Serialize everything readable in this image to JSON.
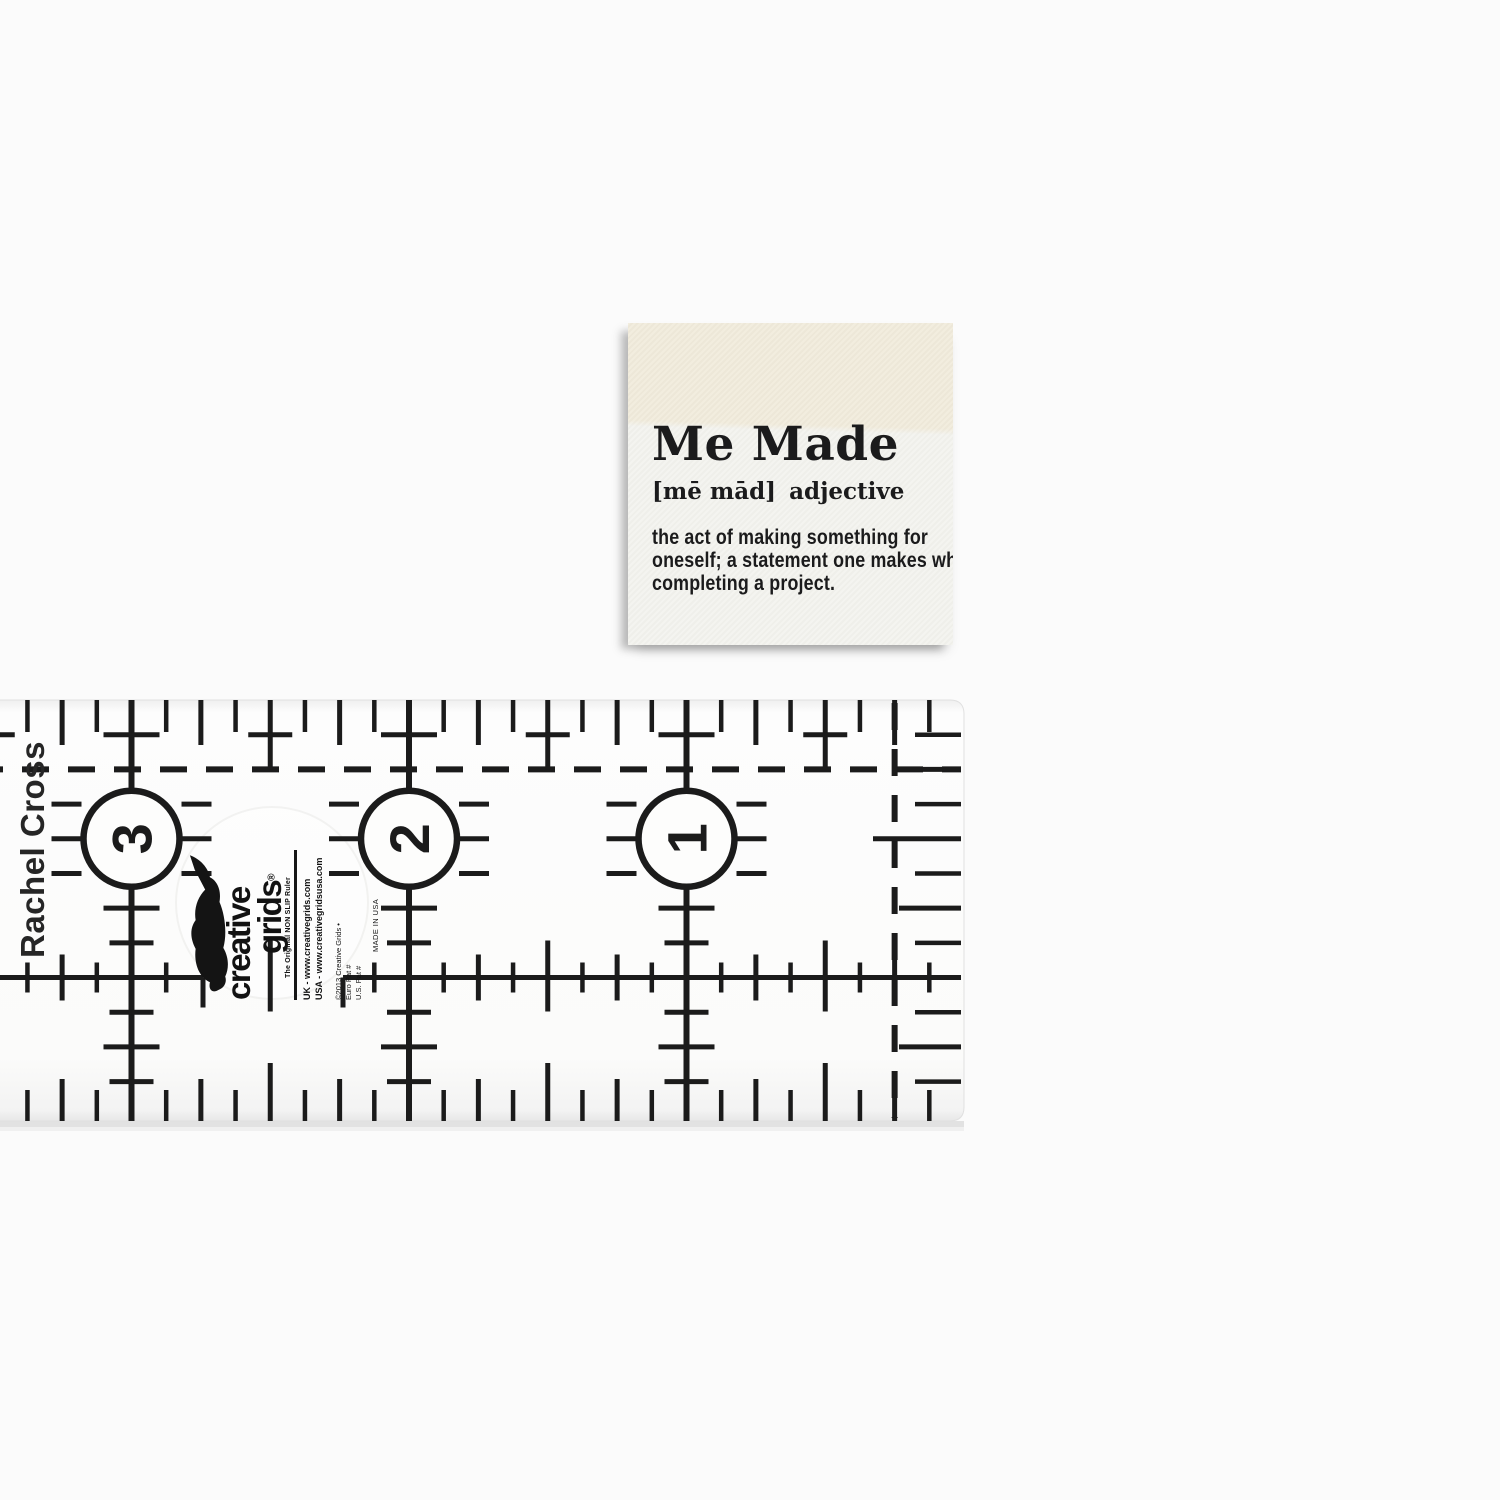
{
  "page": {
    "background": "#fbfbfb"
  },
  "label_tag": {
    "title": "Me Made",
    "pronunciation": "[mē mād]",
    "part_of_speech": "adjective",
    "definition_lines": [
      "the act of making something for",
      "oneself; a statement one makes when",
      "completing a project."
    ],
    "colors": {
      "fold_cream": "#f1ebdb",
      "front_white": "#f3f3ee",
      "text": "#1b1b1c"
    }
  },
  "ruler": {
    "brand_side_text": "Rachel Cross",
    "numbers": [
      {
        "label": "3",
        "inch": 3
      },
      {
        "label": "2",
        "inch": 2
      },
      {
        "label": "1",
        "inch": 1
      }
    ],
    "logo": {
      "word1": "creative",
      "word2": "grids",
      "registered": "®",
      "tagline": "The Original NON SLIP Ruler",
      "url_uk": "UK - www.creativegrids.com",
      "url_usa": "USA - www.creativegridsusa.com",
      "copyright": "©2013 Creative Grids •",
      "patent_eu": "Euro Pat #",
      "patent_us": "U.S. Pat #",
      "made_in": "MADE IN USA"
    },
    "marking_color": "#1b1b1b",
    "geometry": {
      "right_edge_x": 964,
      "top_y": 700,
      "bottom_y": 1121,
      "inch_px": 277.5,
      "left_clip_x": -70
    }
  }
}
